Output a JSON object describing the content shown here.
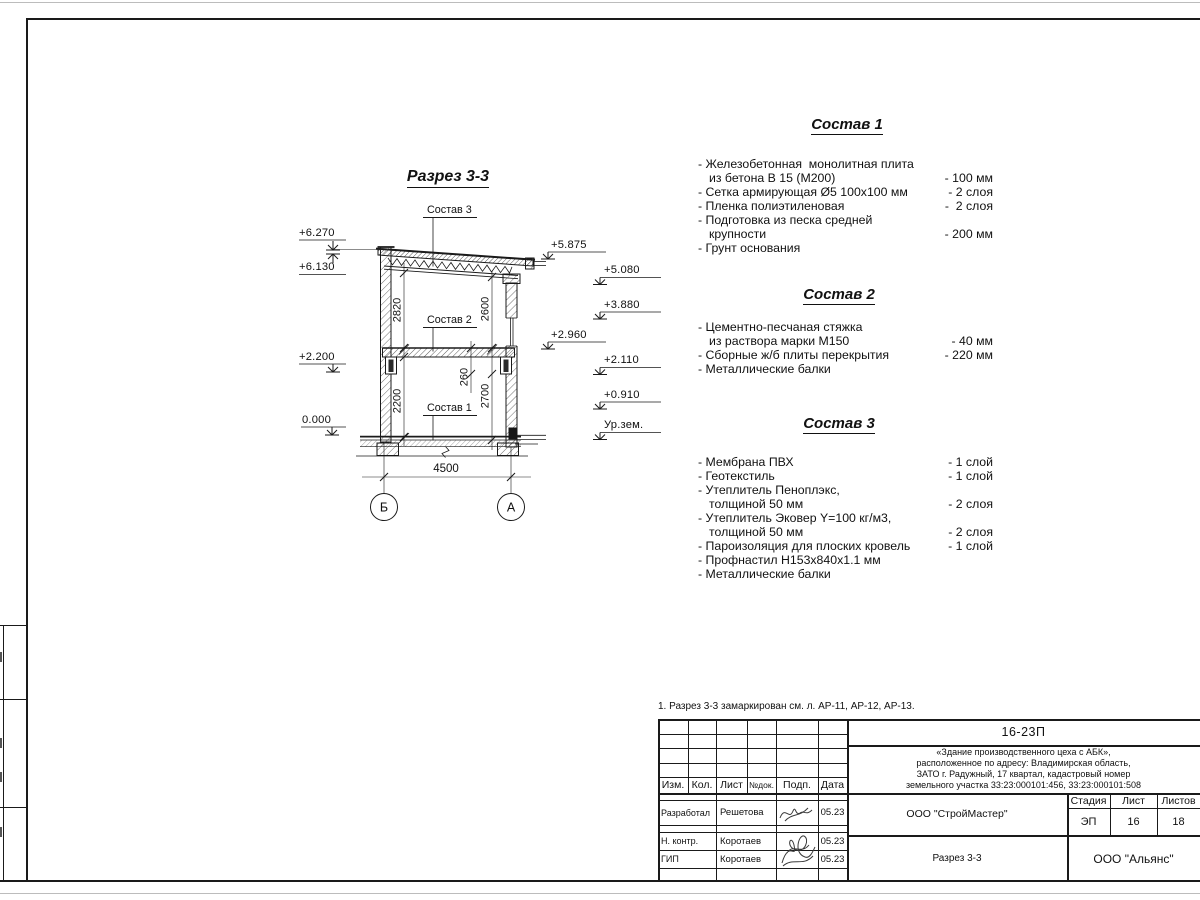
{
  "colors": {
    "ink": "#1a1a1a",
    "paper": "#ffffff"
  },
  "note": "1. Разрез 3-3 замаркирован см. л. АР-11, АР-12, АР-13.",
  "drawing": {
    "title": "Разрез 3-3",
    "callouts": {
      "c1": "Состав 1",
      "c2": "Состав 2",
      "c3": "Состав 3"
    },
    "levels_left": {
      "l1": "+6.270",
      "l2": "+6.130",
      "l3": "+2.200",
      "l4": "0.000"
    },
    "levels_right": {
      "r1": "+5.875",
      "r2": "+5.080",
      "r3": "+3.880",
      "r4": "+2.960",
      "r5": "+2.110",
      "r6": "+0.910",
      "r7": "Ур.зем."
    },
    "dims": {
      "d2820": "2820",
      "d2600": "2600",
      "d2200": "2200",
      "d260": "260",
      "d2700": "2700",
      "d4500": "4500"
    },
    "axes": {
      "left": "Б",
      "right": "А"
    }
  },
  "specs": {
    "s1": {
      "title": "Состав 1",
      "rows": [
        {
          "t": "- Железобетонная  монолитная плита",
          "a": ""
        },
        {
          "t": "из бетона В 15 (М200)",
          "a": "- 100 мм"
        },
        {
          "t": "- Сетка армирующая Ø5 100х100 мм",
          "a": "- 2 слоя"
        },
        {
          "t": "- Пленка полиэтиленовая",
          "a": "-  2 слоя"
        },
        {
          "t": "- Подготовка из песка средней",
          "a": ""
        },
        {
          "t": "крупности",
          "a": "- 200 мм"
        },
        {
          "t": "- Грунт основания",
          "a": ""
        }
      ]
    },
    "s2": {
      "title": "Состав 2",
      "rows": [
        {
          "t": "- Цементно-песчаная стяжка",
          "a": ""
        },
        {
          "t": "из раствора марки М150",
          "a": "- 40 мм"
        },
        {
          "t": "- Сборные ж/б плиты перекрытия",
          "a": "- 220 мм"
        },
        {
          "t": "- Металлические балки",
          "a": ""
        }
      ]
    },
    "s3": {
      "title": "Состав 3",
      "rows": [
        {
          "t": "- Мембрана ПВХ",
          "a": "- 1 слой"
        },
        {
          "t": "- Геотекстиль",
          "a": "- 1 слой"
        },
        {
          "t": "- Утеплитель Пеноплэкс,",
          "a": ""
        },
        {
          "t": "толщиной 50 мм",
          "a": "- 2 слоя"
        },
        {
          "t": "- Утеплитель Эковер Y=100 кг/м3,",
          "a": ""
        },
        {
          "t": "толщиной 50 мм",
          "a": "- 2 слоя"
        },
        {
          "t": "- Пароизоляция для плоских кровель",
          "a": "- 1 слой"
        },
        {
          "t": "- Профнастил Н153х840х1.1 мм",
          "a": ""
        },
        {
          "t": "- Металлические балки",
          "a": ""
        }
      ]
    }
  },
  "titleblock": {
    "doc_code": "16-23П",
    "project_lines": [
      "«Здание производственного цеха с АБК»,",
      "расположенное по адресу: Владимирская область,",
      "ЗАТО г. Радужный, 17 квартал, кадастровый номер",
      "земельного участка 33:23:000101:456, 33:23:000101:508"
    ],
    "rev_headers": {
      "izm": "Изм.",
      "kol": "Кол.",
      "list": "Лист",
      "ndok": "№док.",
      "podp": "Подп.",
      "data": "Дата"
    },
    "roles": [
      {
        "role": "Разработал",
        "name": "Решетова",
        "date": "05.23"
      },
      {
        "role": "Н. контр.",
        "name": "Коротаев",
        "date": "05.23"
      },
      {
        "role": "ГИП",
        "name": "Коротаев",
        "date": "05.23"
      }
    ],
    "contractor": "ООО \"СтройМастер\"",
    "sheet_title": "Разрез 3-3",
    "stage_label": "Стадия",
    "sheet_label": "Лист",
    "sheets_label": "Листов",
    "stage": "ЭП",
    "sheet_no": "16",
    "sheets_total": "18",
    "client": "ООО \"Альянс\""
  }
}
